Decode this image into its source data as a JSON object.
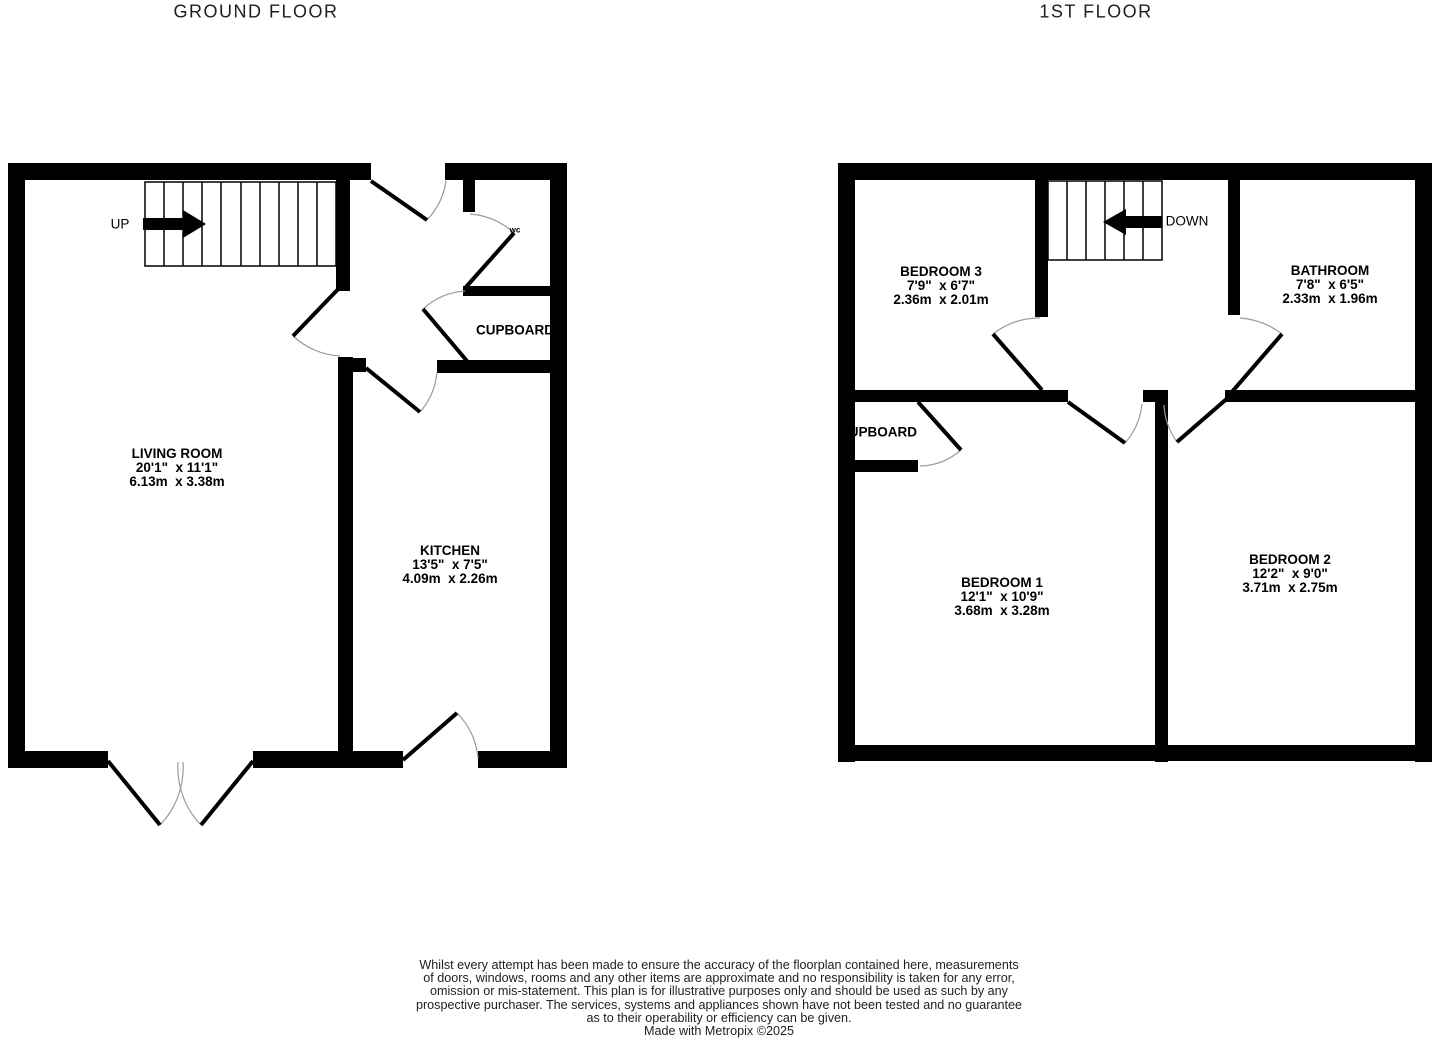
{
  "titles": {
    "ground": "GROUND FLOOR",
    "first": "1ST FLOOR"
  },
  "ground_floor": {
    "stairs_label": "UP",
    "rooms": [
      {
        "name": "LIVING ROOM",
        "imperial": "20'1\"  x 11'1\"",
        "metric": "6.13m  x 3.38m"
      },
      {
        "name": "KITCHEN",
        "imperial": "13'5\"  x 7'5\"",
        "metric": "4.09m  x 2.26m"
      },
      {
        "name": "CUPBOARD"
      },
      {
        "name": "wc"
      }
    ]
  },
  "first_floor": {
    "stairs_label": "DOWN",
    "rooms": [
      {
        "name": "BEDROOM 3",
        "imperial": "7'9\"  x 6'7\"",
        "metric": "2.36m  x 2.01m"
      },
      {
        "name": "BATHROOM",
        "imperial": "7'8\"  x 6'5\"",
        "metric": "2.33m  x 1.96m"
      },
      {
        "name": "BEDROOM 1",
        "imperial": "12'1\"  x 10'9\"",
        "metric": "3.68m  x 3.28m"
      },
      {
        "name": "BEDROOM 2",
        "imperial": "12'2\"  x 9'0\"",
        "metric": "3.71m  x 2.75m"
      },
      {
        "name": "CUPBOARD"
      }
    ]
  },
  "footer": {
    "lines": [
      "Whilst every attempt has been made to ensure the accuracy of the floorplan contained here, measurements",
      "of doors, windows, rooms and any other items are approximate and no responsibility is taken for any error,",
      "omission or mis-statement. This plan is for illustrative purposes only and should be used as such by any",
      "prospective purchaser. The services, systems and appliances shown have not been tested and no guarantee",
      "as to their operability or efficiency can be given.",
      "Made with Metropix ©2025"
    ]
  },
  "colors": {
    "wall": "#000000",
    "door_arc": "#9a9a9a",
    "text": "#000000",
    "title_text": "#1f1f1f"
  }
}
